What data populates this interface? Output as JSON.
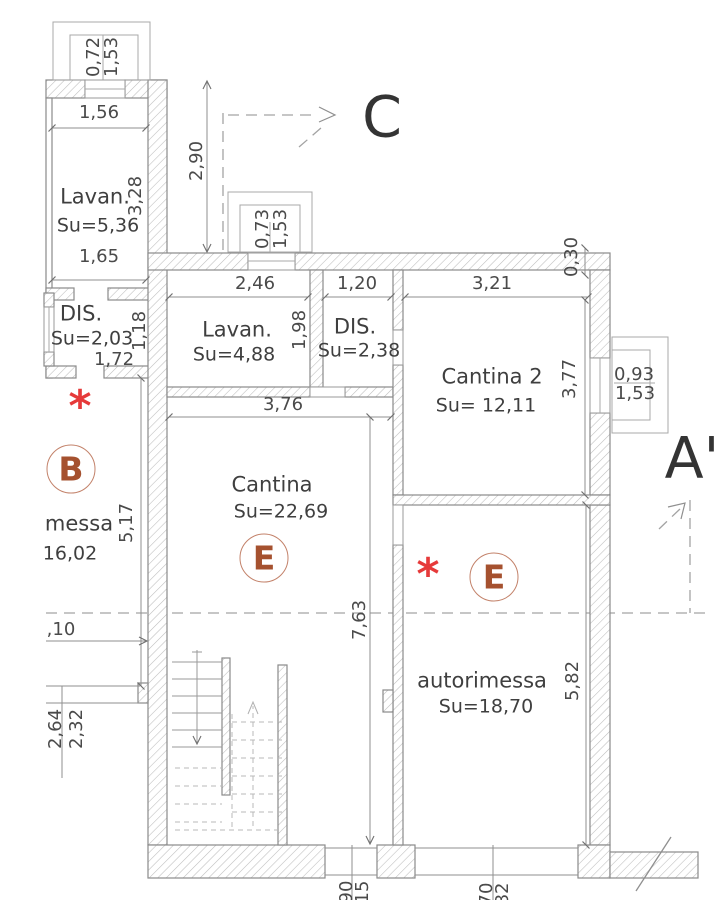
{
  "sections": {
    "c_label": "C",
    "a_prime_label": "A'"
  },
  "markers": {
    "b": "B",
    "e1": "E",
    "e2": "E",
    "asterisk_left": "*",
    "asterisk_right": "*"
  },
  "rooms": {
    "lav_nw": {
      "name": "Lavan.",
      "area": "Su=5,36"
    },
    "dis_w": {
      "name": "DIS.",
      "area": "Su=2,03",
      "width": "1,72"
    },
    "b_unit": {
      "name_partial": "messa",
      "area_partial": "16,02"
    },
    "lav_c": {
      "name": "Lavan.",
      "area": "Su=4,88"
    },
    "dis_c": {
      "name": "DIS.",
      "area": "Su=2,38"
    },
    "cantina2": {
      "name": "Cantina 2",
      "area": "Su= 12,11"
    },
    "cantina": {
      "name": "Cantina",
      "area": "Su=22,69"
    },
    "autorimessa": {
      "name": "autorimessa",
      "area": "Su=18,70"
    }
  },
  "dims": {
    "win_nw_1": "0,72",
    "win_nw_2": "1,53",
    "nw_top": "1,56",
    "nw_h": "3,28",
    "nw_bottom": "1,65",
    "wing_gap_h": "2,90",
    "dis_w_h": "1,18",
    "win_c_1": "0,73",
    "win_c_2": "1,53",
    "lav_c_w": "2,46",
    "lav_c_h": "1,98",
    "dis_c_w": "1,20",
    "c2_w": "3,21",
    "c2_h": "3,77",
    "wall_tr": "0,30",
    "win_e_1": "0,93",
    "win_e_2": "1,53",
    "cant_w": "3,76",
    "cant_h": "7,63",
    "auto_h": "5,82",
    "b_h": "5,17",
    "b_cut": ",10",
    "b_n1": "2,64",
    "b_n2": "2,32",
    "bot_1": "90",
    "bot_2": "15",
    "bot_3": "70",
    "bot_4": "82"
  },
  "colors": {
    "wall_hatch": "#bdbdbd",
    "wall_stroke": "#8a8a8a",
    "marker_red": "#a5512f",
    "asterisk_red": "#e63a3a",
    "text": "#3f3f3f"
  }
}
